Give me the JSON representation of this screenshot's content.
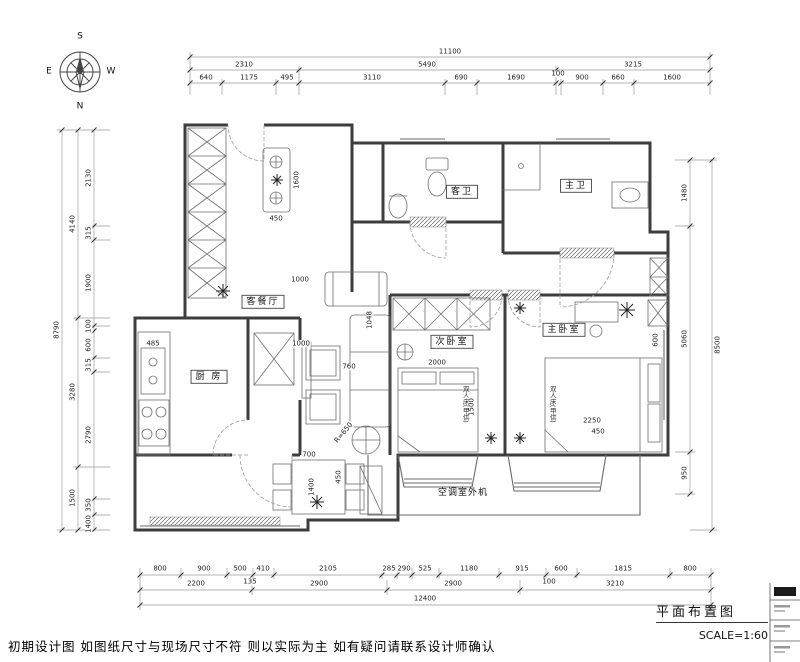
{
  "meta": {
    "plan_title": "平面布置图",
    "scale": "SCALE=1:60",
    "disclaimer": "初期设计图 如图纸尺寸与现场尺寸不符 则以实际为主 如有疑问请联系设计师确认"
  },
  "compass": {
    "n": "N",
    "s": "S",
    "e": "E",
    "w": "W"
  },
  "rooms": {
    "living": "客餐厅",
    "kitchen": "厨 房",
    "second_bedroom": "次卧室",
    "master_bedroom": "主卧室",
    "guest_bath": "客卫",
    "master_bath": "主卫",
    "ac_unit": "空调室外机"
  },
  "furniture": {
    "double_bed": "双人床(甲供)",
    "round_table_radius": "R=650"
  },
  "dims": {
    "top": {
      "overall": "11100",
      "tier2": [
        "2310",
        "5490",
        "3215"
      ],
      "tier3": [
        "640",
        "1175",
        "495",
        "3110",
        "690",
        "1690",
        "100",
        "900",
        "660",
        "1600"
      ]
    },
    "left": {
      "overall": "8790",
      "tier2": [
        "4140",
        "3280",
        "1500"
      ],
      "tier3": [
        "2130",
        "315",
        "1900",
        "100",
        "600",
        "315",
        "2790",
        "350",
        "1400"
      ]
    },
    "right": {
      "overall": "8500",
      "tier2": [
        "1480",
        "5060",
        "950"
      ]
    },
    "bottom": {
      "overall": "12400",
      "tier2": [
        "2200",
        "2900",
        "2900",
        "3210"
      ],
      "tier1": [
        "800",
        "900",
        "500",
        "410",
        "2105",
        "285",
        "290",
        "525",
        "1180",
        "915",
        "600",
        "1815",
        "800"
      ],
      "sub": [
        "135",
        "100"
      ]
    },
    "interior": {
      "sofa_side": "1000",
      "tv_wall": "1000",
      "sofa_depth": "1048",
      "sofa_seat": "760",
      "dining_w": "700",
      "dining_d": "450",
      "dining_l": "1400",
      "bed2_w": "2000",
      "bed2_l": "1500",
      "bed1_w": "2250",
      "bed1_gap": "450",
      "bed1_side": "600",
      "sink_w": "485",
      "console_w": "450",
      "console_l": "1600"
    }
  }
}
